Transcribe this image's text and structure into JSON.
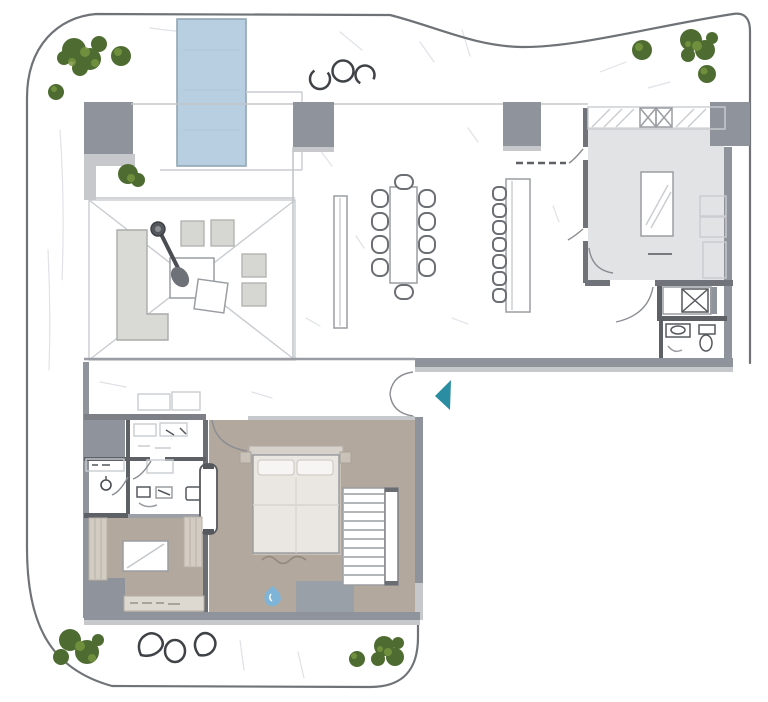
{
  "meta": {
    "type": "architectural-floor-plan",
    "style": "hand-sketch top-down rendering",
    "visible_text": "none"
  },
  "colors": {
    "boundary": "#6f7378",
    "wall": "#8f939b",
    "wall_light": "#c6c8cc",
    "wall_dark": "#5d6065",
    "pool": "#b7cfe0",
    "pool_edge": "#92a6b3",
    "floor_kitchen": "#e2e3e5",
    "floor_taupe": "#b2a89e",
    "floor_taupe_light": "#cdc6bc",
    "sofa": "#d9dad6",
    "furniture_line": "#6b6e73",
    "tree_dark": "#4e6c31",
    "tree_light": "#77953f",
    "stone": "#3f4246",
    "arrow_teal": "#2b8da2",
    "droplet_blue": "#7db4d8",
    "sketch": "#dfe2e6"
  },
  "site": {
    "boundary_shape": "rounded L-shaped plot with wavy top-right edge",
    "pool": {
      "shape": "rectangle",
      "position": "top-left terrace"
    },
    "stones_top_count": 3,
    "stones_bottom_count": 3,
    "tree_groups_count": 10
  },
  "building": {
    "rooms": [
      {
        "name": "pool-terrace",
        "features": [
          "swimming-pool",
          "pergola-lounge",
          "l-shaped-sofa",
          "cantilever-parasol",
          "coffee-tables",
          "ottomans"
        ]
      },
      {
        "name": "living-dining-room",
        "features": [
          "dining-table",
          "dining-chairs",
          "sideboard",
          "breakfast-bar",
          "bar-stools"
        ]
      },
      {
        "name": "kitchen",
        "features": [
          "island",
          "wall-cabinets",
          "tall-cabinets"
        ]
      },
      {
        "name": "bathroom-right",
        "features": [
          "shower",
          "washbasin",
          "wc"
        ]
      },
      {
        "name": "entry-hall",
        "features": [
          "double-entry-door"
        ]
      },
      {
        "name": "master-bedroom",
        "features": [
          "double-bed",
          "pillows",
          "sliding-door",
          "staircase"
        ]
      },
      {
        "name": "bathroom-left",
        "features": [
          "walk-in-closet",
          "vanity",
          "washbasin",
          "wc"
        ]
      },
      {
        "name": "bedroom-2",
        "features": [
          "bed",
          "wardrobes",
          "sideboard"
        ]
      }
    ]
  },
  "furniture_counts": {
    "dining_chairs": 10,
    "bar_stools": 7,
    "lounge_ottomans": 4,
    "stair_treads": 10,
    "beds": 2
  },
  "icons": [
    {
      "name": "entrance-arrow-icon",
      "glyph": "left-pointing triangle",
      "color": "#2b8da2"
    },
    {
      "name": "water-drop-icon",
      "glyph": "teardrop",
      "color": "#7db4d8"
    }
  ]
}
